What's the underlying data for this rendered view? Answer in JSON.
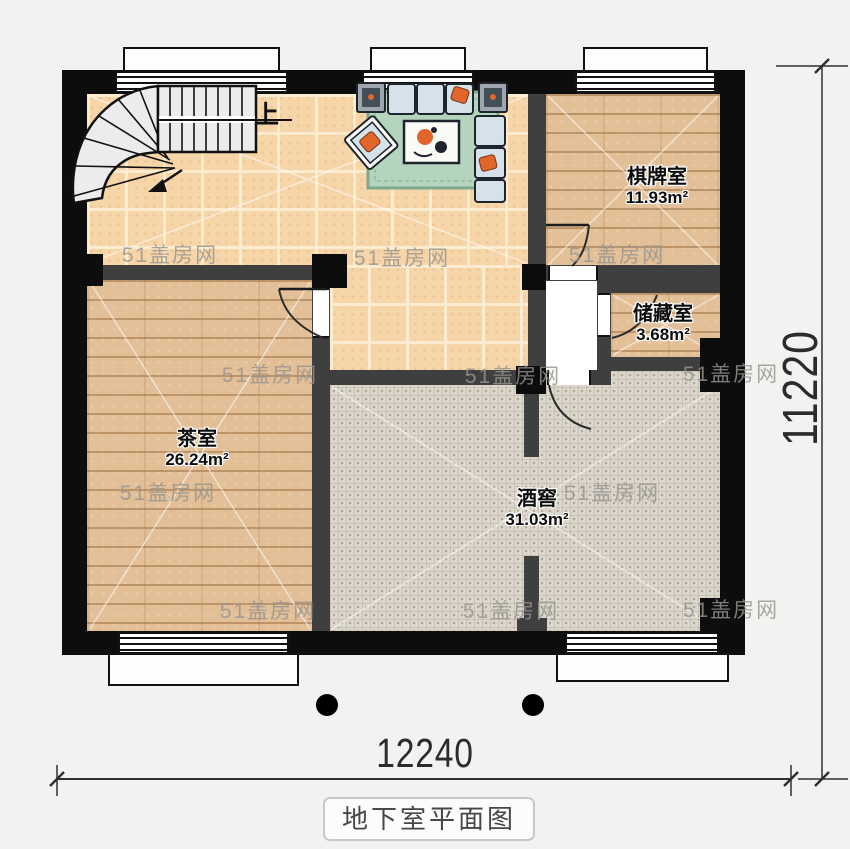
{
  "plan": {
    "title": "地下室平面图",
    "watermark_text": "51盖房网",
    "stair_direction_label": "上",
    "dimension_bottom": "12240",
    "dimension_right": "11220",
    "rooms": [
      {
        "id": "chess-room",
        "name": "棋牌室",
        "area": "11.93m²"
      },
      {
        "id": "storage-room",
        "name": "储藏室",
        "area": "3.68m²"
      },
      {
        "id": "tea-room",
        "name": "茶室",
        "area": "26.24m²"
      },
      {
        "id": "wine-cellar",
        "name": "酒窖",
        "area": "31.03m²"
      }
    ],
    "colors": {
      "exterior_wall": "#0d0d0d",
      "interior_wall": "#3f3f3f",
      "tile_floor": "#f6d5a9",
      "wood_floor": "#e2bf97",
      "cellar_floor": "#dcd7cd",
      "rug_green": "#b5d4be",
      "accent_orange": "#e0662c",
      "watermark": "#979590"
    }
  }
}
